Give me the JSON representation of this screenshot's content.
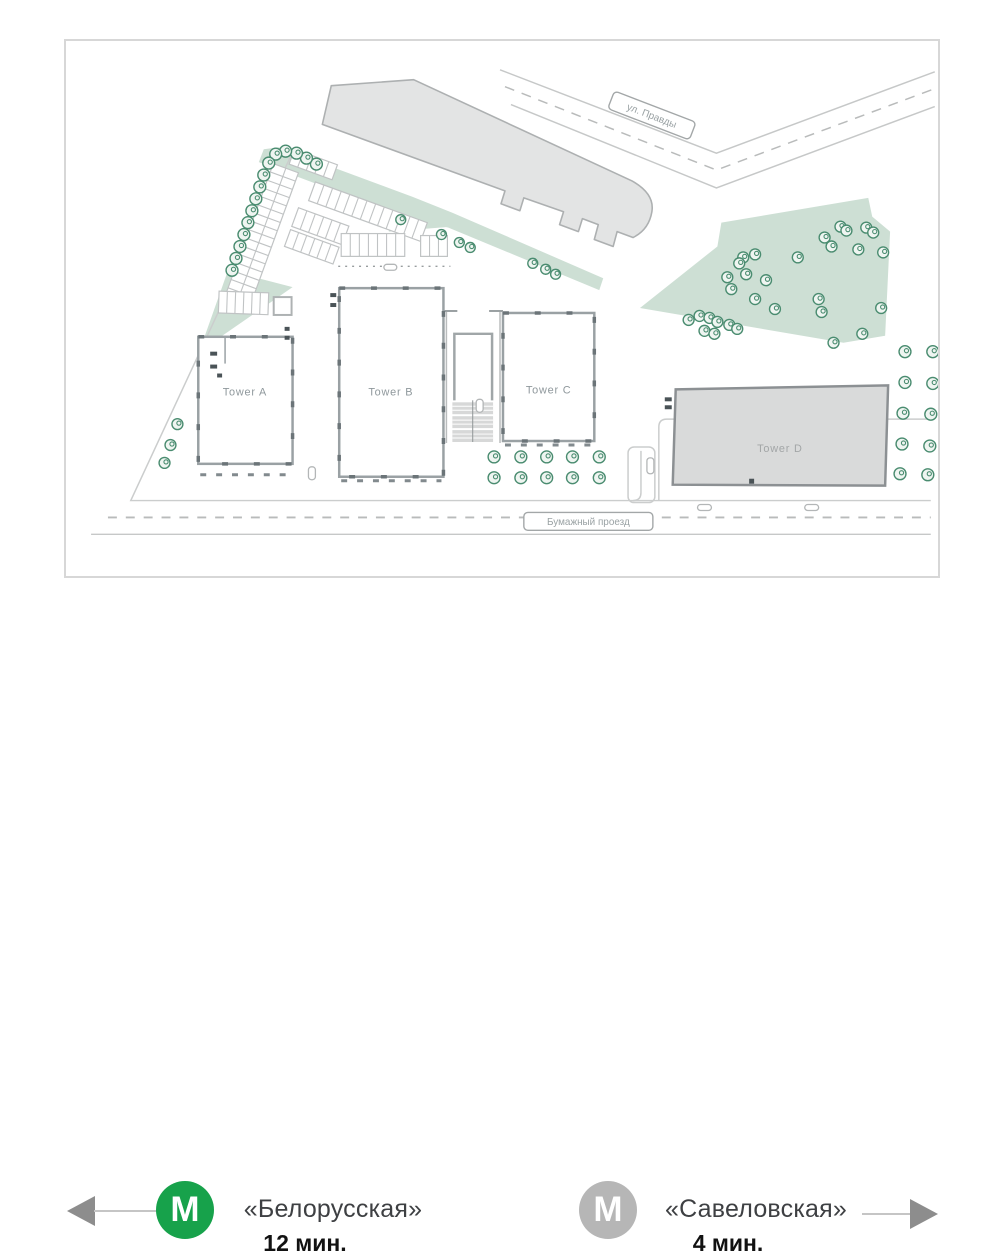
{
  "site_plan": {
    "street_top": {
      "label": "ул. Правды"
    },
    "street_bottom": {
      "label": "Бумажный проезд"
    },
    "towers": [
      {
        "label": "Tower A"
      },
      {
        "label": "Tower B"
      },
      {
        "label": "Tower C"
      },
      {
        "label": "Tower D"
      }
    ]
  },
  "legend": {
    "metro_symbol": "M",
    "left": {
      "name": "«Белорусская»",
      "time": "12 мин.",
      "badge_color": "#17a24b",
      "arrow_direction": "left"
    },
    "right": {
      "name": "«Савеловская»",
      "time": "4 мин.",
      "badge_color": "#b6b6b6",
      "arrow_direction": "right"
    }
  },
  "colors": {
    "park_fill": "#cddfd4",
    "tree_stroke": "#4a8c70",
    "tree_fill": "#eff5f1",
    "existing_building_fill": "#e3e4e4",
    "existing_building_stroke": "#adb0b1",
    "tower_fill": "#ffffff",
    "tower_stroke": "#9aa1a4",
    "tower_dash": "#6b7478",
    "tower_d_fill": "#d9dada",
    "tower_d_stroke": "#8c9093",
    "tower_label": "#8f989c",
    "tower_d_label": "#a3a6a7",
    "parking_stroke": "#c0c3c4",
    "road_line": "#c6c8c8",
    "road_dash": "#b9bbbb",
    "boundary_line": "#cbcdcd",
    "label_text": "#9aa2a4",
    "label_border": "#a3a7a8",
    "stair_fill": "#d7d8d8",
    "mark_dark": "#4a5357",
    "arrow_line": "#c5c5c5",
    "arrow_head": "#8d8d8d",
    "station_name": "#3e4043",
    "station_time": "#121212"
  },
  "vegetation": {
    "groups": [
      {
        "name": "boundary-row",
        "r": 6,
        "trees": [
          [
            315,
            163
          ],
          [
            305,
            157
          ],
          [
            295,
            152
          ],
          [
            284,
            150
          ],
          [
            274,
            153
          ],
          [
            267,
            162
          ],
          [
            262,
            174
          ],
          [
            258,
            186
          ],
          [
            254,
            198
          ],
          [
            250,
            210
          ],
          [
            246,
            222
          ],
          [
            242,
            234
          ],
          [
            238,
            246
          ],
          [
            234,
            258
          ],
          [
            230,
            270
          ]
        ]
      },
      {
        "name": "tower-a-side",
        "r": 5.5,
        "trees": [
          [
            175,
            425
          ],
          [
            168,
            446
          ],
          [
            162,
            464
          ]
        ]
      },
      {
        "name": "walkway",
        "r": 5,
        "trees": [
          [
            400,
            219
          ],
          [
            441,
            234
          ],
          [
            459,
            242
          ],
          [
            470,
            247
          ],
          [
            533,
            263
          ],
          [
            546,
            269
          ],
          [
            556,
            274
          ]
        ]
      },
      {
        "name": "court-grid",
        "r": 6,
        "trees": [
          [
            494,
            458
          ],
          [
            521,
            458
          ],
          [
            547,
            458
          ],
          [
            573,
            458
          ],
          [
            600,
            458
          ],
          [
            494,
            479
          ],
          [
            521,
            479
          ],
          [
            547,
            479
          ],
          [
            573,
            479
          ],
          [
            600,
            479
          ]
        ]
      },
      {
        "name": "tower-d-side",
        "r": 6,
        "trees": [
          [
            908,
            352
          ],
          [
            936,
            352
          ],
          [
            908,
            383
          ],
          [
            936,
            384
          ],
          [
            906,
            414
          ],
          [
            934,
            415
          ],
          [
            905,
            445
          ],
          [
            933,
            447
          ],
          [
            903,
            475
          ],
          [
            931,
            476
          ]
        ]
      },
      {
        "name": "park",
        "r": 5.5,
        "trees": [
          [
            690,
            320
          ],
          [
            701,
            316
          ],
          [
            711,
            318
          ],
          [
            719,
            322
          ],
          [
            731,
            325
          ],
          [
            739,
            329
          ],
          [
            706,
            331
          ],
          [
            716,
            334
          ],
          [
            745,
            257
          ],
          [
            757,
            254
          ],
          [
            741,
            263
          ],
          [
            729,
            277
          ],
          [
            733,
            289
          ],
          [
            748,
            274
          ],
          [
            768,
            280
          ],
          [
            757,
            299
          ],
          [
            777,
            309
          ],
          [
            800,
            257
          ],
          [
            827,
            237
          ],
          [
            834,
            246
          ],
          [
            843,
            226
          ],
          [
            849,
            230
          ],
          [
            869,
            227
          ],
          [
            876,
            232
          ],
          [
            861,
            249
          ],
          [
            821,
            299
          ],
          [
            824,
            312
          ],
          [
            836,
            343
          ],
          [
            865,
            334
          ],
          [
            884,
            308
          ],
          [
            886,
            252
          ]
        ]
      }
    ]
  },
  "parking_rows": [
    {
      "x": 223,
      "y": 296,
      "angle": -70,
      "length": 142,
      "depth": 27,
      "stalls": 16,
      "mid": true
    },
    {
      "x": 293,
      "y": 148,
      "angle": 20,
      "length": 46,
      "depth": 16,
      "stalls": 5
    },
    {
      "x": 314,
      "y": 181,
      "angle": 20,
      "length": 120,
      "depth": 20,
      "stalls": 13
    },
    {
      "x": 297,
      "y": 207,
      "angle": 20,
      "length": 54,
      "depth": 20,
      "stalls": 6
    },
    {
      "x": 289,
      "y": 229,
      "angle": 20,
      "length": 52,
      "depth": 18,
      "stalls": 6
    },
    {
      "x": 340,
      "y": 233,
      "angle": 0,
      "length": 64,
      "depth": 23,
      "stalls": 7
    },
    {
      "x": 420,
      "y": 235,
      "angle": 0,
      "length": 27,
      "depth": 21,
      "stalls": 3
    },
    {
      "x": 217,
      "y": 291,
      "angle": 2,
      "length": 50,
      "depth": 22,
      "stalls": 6
    }
  ],
  "road_marks": [
    [
      383,
      264,
      13,
      6
    ],
    [
      476,
      400,
      7,
      13
    ],
    [
      648,
      459,
      7,
      16
    ],
    [
      699,
      506,
      14,
      6
    ],
    [
      807,
      506,
      14,
      6
    ],
    [
      307,
      468,
      7,
      13
    ]
  ]
}
